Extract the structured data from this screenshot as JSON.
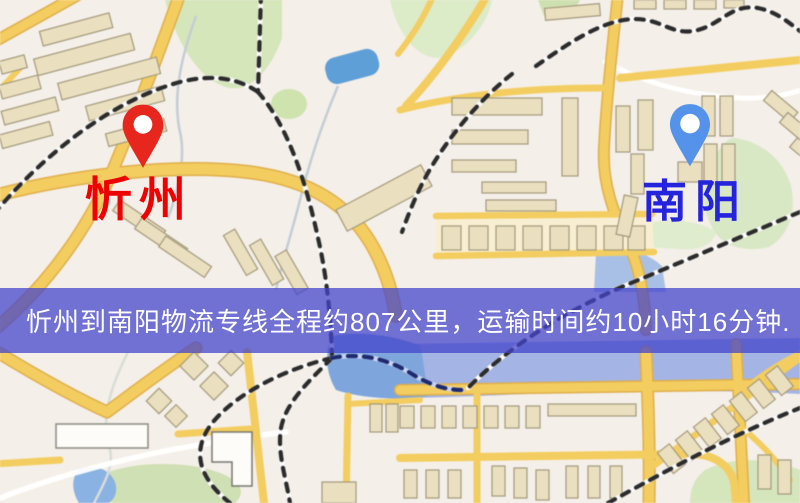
{
  "map": {
    "origin": {
      "name": "忻州",
      "pin_color": "#e7271d",
      "label_color": "#ee0000"
    },
    "destination": {
      "name": "南阳",
      "pin_color": "#5593ea",
      "label_color": "#2424dc"
    },
    "style_palette": {
      "background": "#f4efe8",
      "road_yellow": "#f3cd5f",
      "road_casing": "#dfाई",
      "building_fill": "#eadfbe",
      "building_stroke": "#a3997c",
      "water_blue": "#7ea6dd",
      "river_lavender": "#a4b4e4",
      "park_green": "#d5e6ba",
      "railway_dash": "#2b2b2b"
    }
  },
  "banner": {
    "text": "忻州到南阳物流专线全程约807公里，运输时间约10小时16分钟.",
    "route": "忻州到南阳物流专线",
    "distance": "807公里",
    "duration": "10小时16分钟",
    "background_color": "#4444cc",
    "text_color": "#ffffff"
  }
}
